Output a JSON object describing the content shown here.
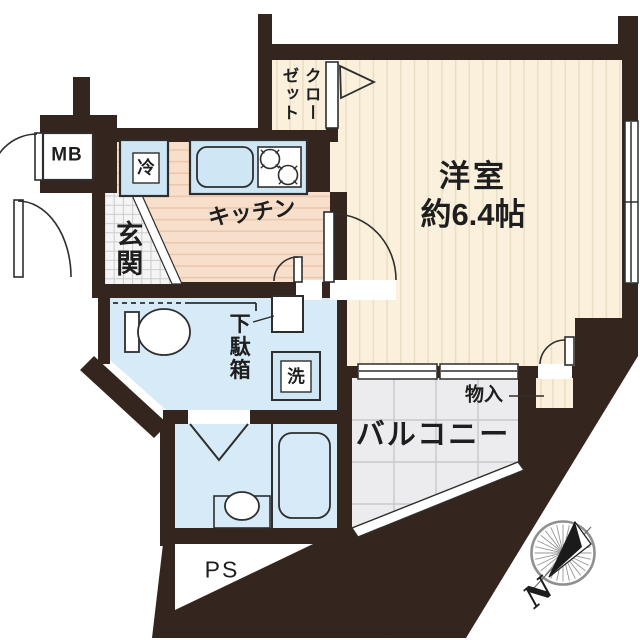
{
  "plan_type": "apartment-floor-plan",
  "rooms": {
    "main_room": {
      "name": "洋室",
      "area": "約6.4帖"
    },
    "kitchen": {
      "name": "キッチン"
    },
    "closet": {
      "name": "クローゼット"
    },
    "entrance": {
      "name": "玄関"
    },
    "balcony": {
      "name": "バルコニー"
    },
    "storage": {
      "name": "物入"
    },
    "shoe_cabinet": {
      "name": "下駄箱"
    },
    "meter_box": {
      "label": "MB"
    },
    "pipe_space": {
      "label": "PS"
    },
    "refrigerator": {
      "label": "冷"
    },
    "washing_machine": {
      "label": "洗"
    }
  },
  "compass": {
    "north_label": "N"
  },
  "colors": {
    "wall": "#34251e",
    "room_floor": "#faf0dc",
    "room_stripe": "#eadfc4",
    "kitchen_floor": "#f7dfcb",
    "kitchen_stripe": "#ebc7ac",
    "wet_area": "#d6eaf7",
    "fixture_blue": "#cfe6f4",
    "balcony_tile": "#ececee",
    "entrance_tile": "#f5f5f5",
    "line": "#2e2e2e"
  }
}
